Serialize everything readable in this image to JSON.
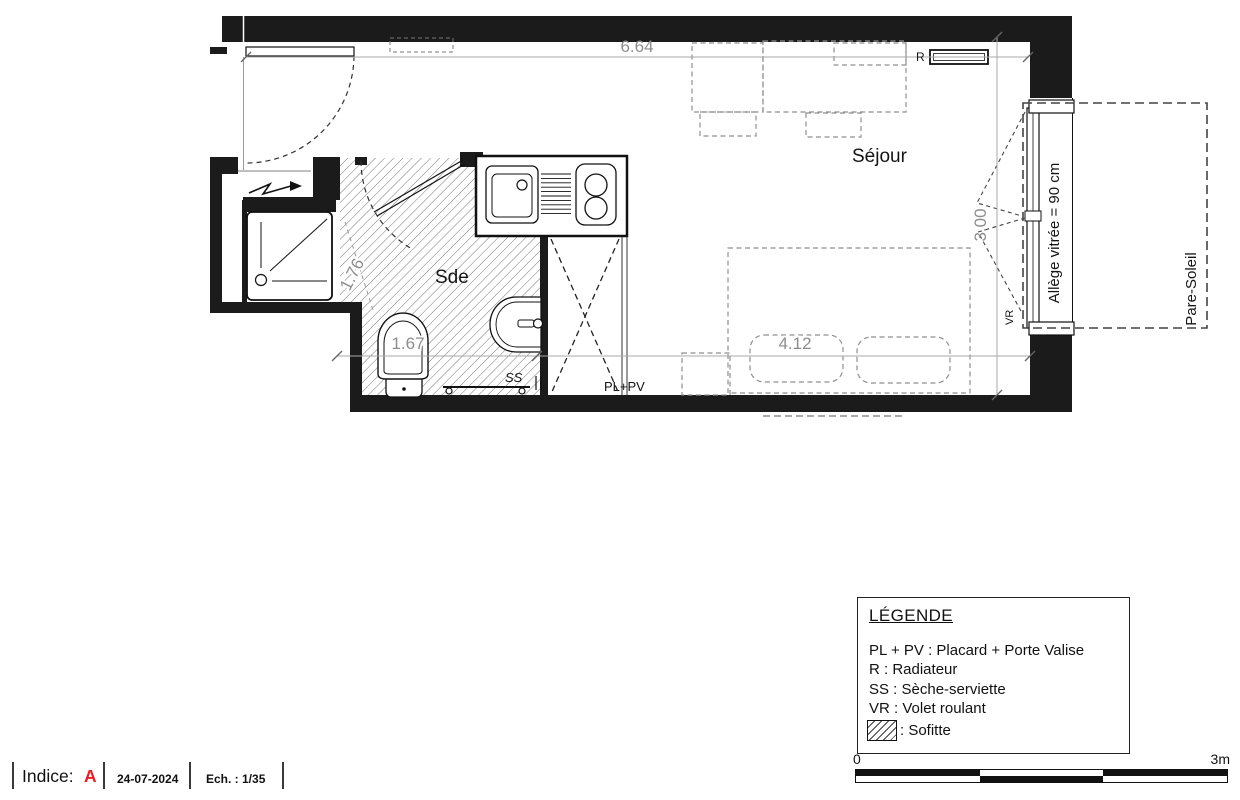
{
  "plan": {
    "rooms": {
      "sejour": "Séjour",
      "sde": "Sde"
    },
    "dims": {
      "total_width": "6.64",
      "room_depth": "3.00",
      "bed_zone": "4.12",
      "sde_width": "1.67",
      "entry_diag": "1.76"
    },
    "labels": {
      "radiator": "R",
      "towel_dryer": "SS",
      "closet": "PL+PV",
      "roller_shutter": "VR",
      "glazing_sill": "Allège vitrée = 90 cm",
      "sun_shade": "Pare-Soleil"
    }
  },
  "legend": {
    "title": "LÉGENDE",
    "entries": [
      "PL + PV : Placard + Porte Valise",
      "R : Radiateur",
      "SS : Sèche-serviette",
      "VR : Volet roulant"
    ],
    "hatch_label": ": Sofitte"
  },
  "scale_bar": {
    "start": "0",
    "end": "3m"
  },
  "title_block": {
    "indice_label": "Indice:",
    "indice_value": "A",
    "date": "24-07-2024",
    "scale": "Ech. : 1/35"
  },
  "colors": {
    "indice_red": "#ed1c24",
    "wall_black": "#1b1b1b",
    "dim_gray": "#8d8d8d"
  }
}
